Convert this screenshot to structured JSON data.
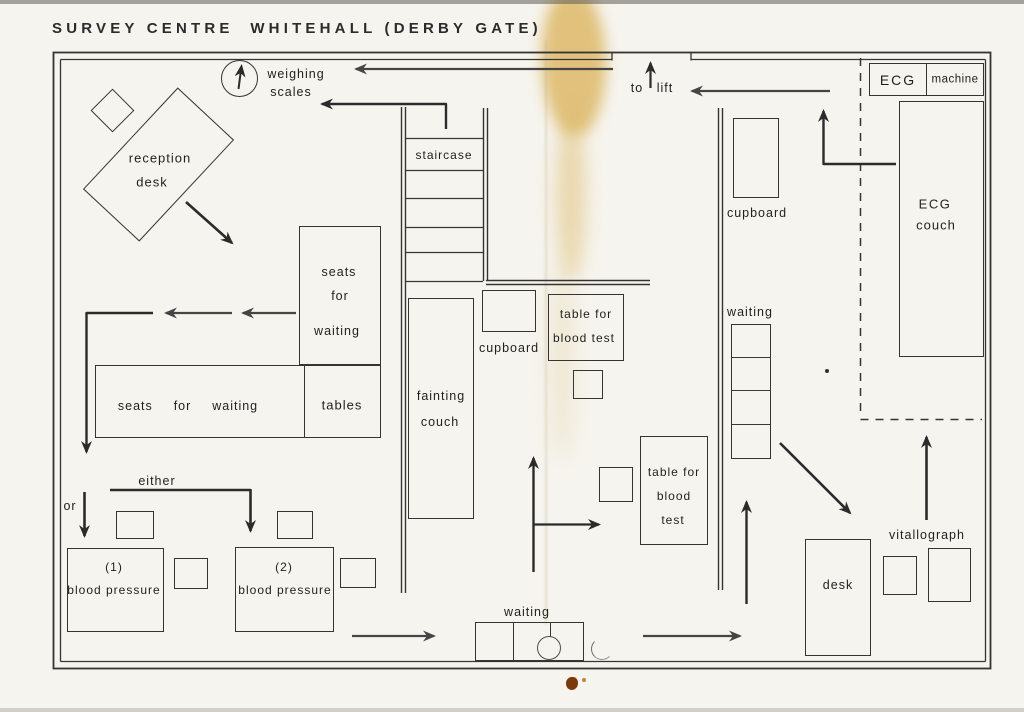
{
  "title": "SURVEY CENTRE  WHITEHALL (DERBY GATE)",
  "colors": {
    "ink": "#2f2f2f",
    "arrow": "#2b2b2b",
    "stain": "#dcb55f",
    "stain_dot": "#7a3a0c"
  },
  "areas": {
    "weighing_scales": {
      "line1": "weighing",
      "line2": "scales"
    },
    "to_lift": {
      "line1": "to",
      "line2": "lift"
    },
    "reception_desk": {
      "line1": "reception",
      "line2": "desk"
    },
    "staircase": {
      "label": "staircase"
    },
    "ecg_machine": {
      "box1": "ECG",
      "box2": "machine"
    },
    "ecg_couch": {
      "line1": "ECG",
      "line2": "couch"
    },
    "cupboard_top_right": {
      "label": "cupboard"
    },
    "waiting_right": {
      "label": "waiting"
    },
    "seats_for_waiting_vertical": {
      "line1": "seats",
      "line2": "for",
      "line3": "waiting"
    },
    "seats_for_waiting_horizontal": {
      "label": "seats  for  waiting"
    },
    "tables": {
      "label": "tables"
    },
    "fainting_couch": {
      "line1": "fainting",
      "line2": "couch"
    },
    "cupboard_middle": {
      "label": "cupboard"
    },
    "blood_test_table_1": {
      "line1": "table for",
      "line2": "blood test"
    },
    "blood_test_table_2": {
      "line1": "table for",
      "line2": "blood",
      "line3": "test"
    },
    "route": {
      "either": "either",
      "or": "or"
    },
    "blood_pressure_1": {
      "line1": "(1)",
      "line2": "blood pressure"
    },
    "blood_pressure_2": {
      "line1": "(2)",
      "line2": "blood pressure"
    },
    "waiting_bottom": {
      "label": "waiting"
    },
    "desk": {
      "label": "desk"
    },
    "vitallograph": {
      "label": "vitallograph"
    }
  }
}
